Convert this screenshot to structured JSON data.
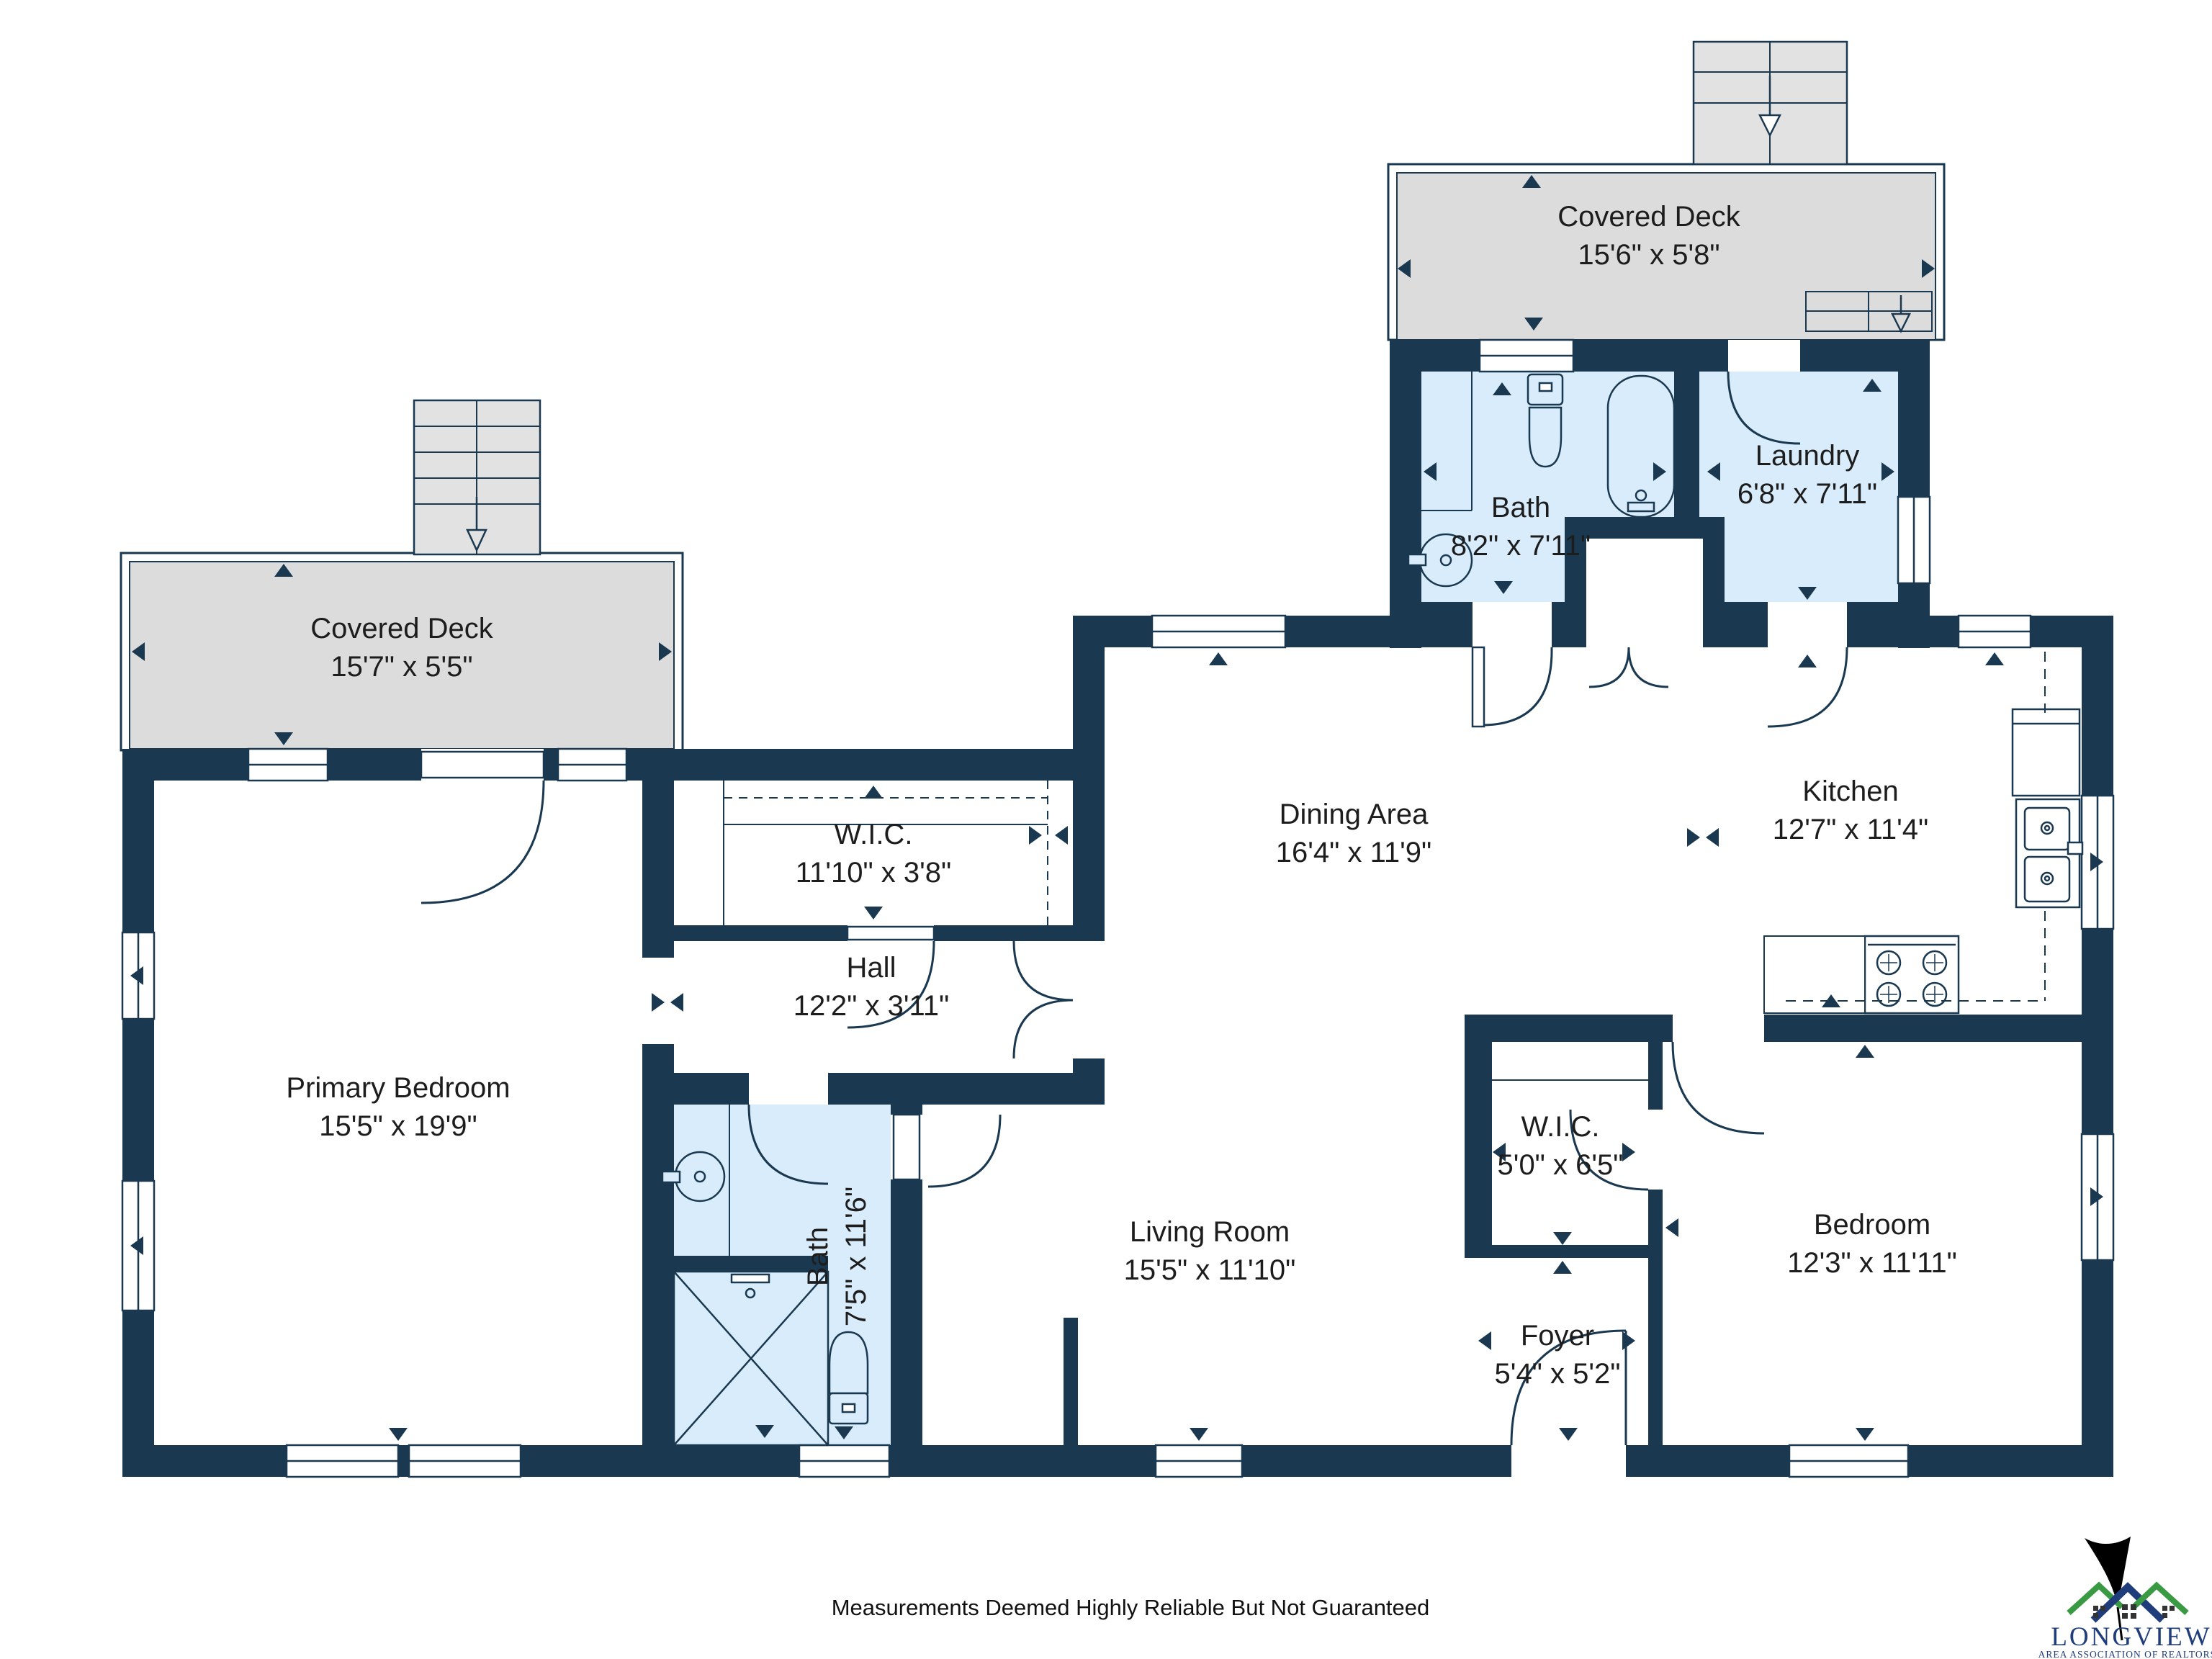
{
  "plan": {
    "rooms": {
      "covered_deck_top": {
        "name": "Covered Deck",
        "dims": "15'6\" x 5'8\""
      },
      "bath_top": {
        "name": "Bath",
        "dims": "8'2\" x 7'11\""
      },
      "laundry": {
        "name": "Laundry",
        "dims": "6'8\" x 7'11\""
      },
      "covered_deck_left": {
        "name": "Covered Deck",
        "dims": "15'7\" x 5'5\""
      },
      "wic_main": {
        "name": "W.I.C.",
        "dims": "11'10\" x 3'8\""
      },
      "dining": {
        "name": "Dining Area",
        "dims": "16'4\" x 11'9\""
      },
      "kitchen": {
        "name": "Kitchen",
        "dims": "12'7\" x 11'4\""
      },
      "hall": {
        "name": "Hall",
        "dims": "12'2\" x 3'11\""
      },
      "primary_bedroom": {
        "name": "Primary Bedroom",
        "dims": "15'5\" x 19'9\""
      },
      "bath_main": {
        "name": "Bath",
        "dims": "7'5\" x 11'6\""
      },
      "living": {
        "name": "Living Room",
        "dims": "15'5\" x 11'10\""
      },
      "wic_small": {
        "name": "W.I.C.",
        "dims": "5'0\" x 6'5\""
      },
      "foyer": {
        "name": "Foyer",
        "dims": "5'4\" x 5'2\""
      },
      "bedroom": {
        "name": "Bedroom",
        "dims": "12'3\" x 11'11\""
      }
    },
    "disclaimer": "Measurements Deemed Highly Reliable But Not Guaranteed",
    "logo": {
      "title": "LONGVIEW",
      "subtitle": "AREA ASSOCIATION OF REALTORS®"
    },
    "colors": {
      "wall": "#1a3950",
      "wet_room": "#d8ecfb",
      "deck": "#dcdcdd",
      "logo_blue": "#1f3d7a",
      "logo_green": "#3a9a44"
    }
  }
}
